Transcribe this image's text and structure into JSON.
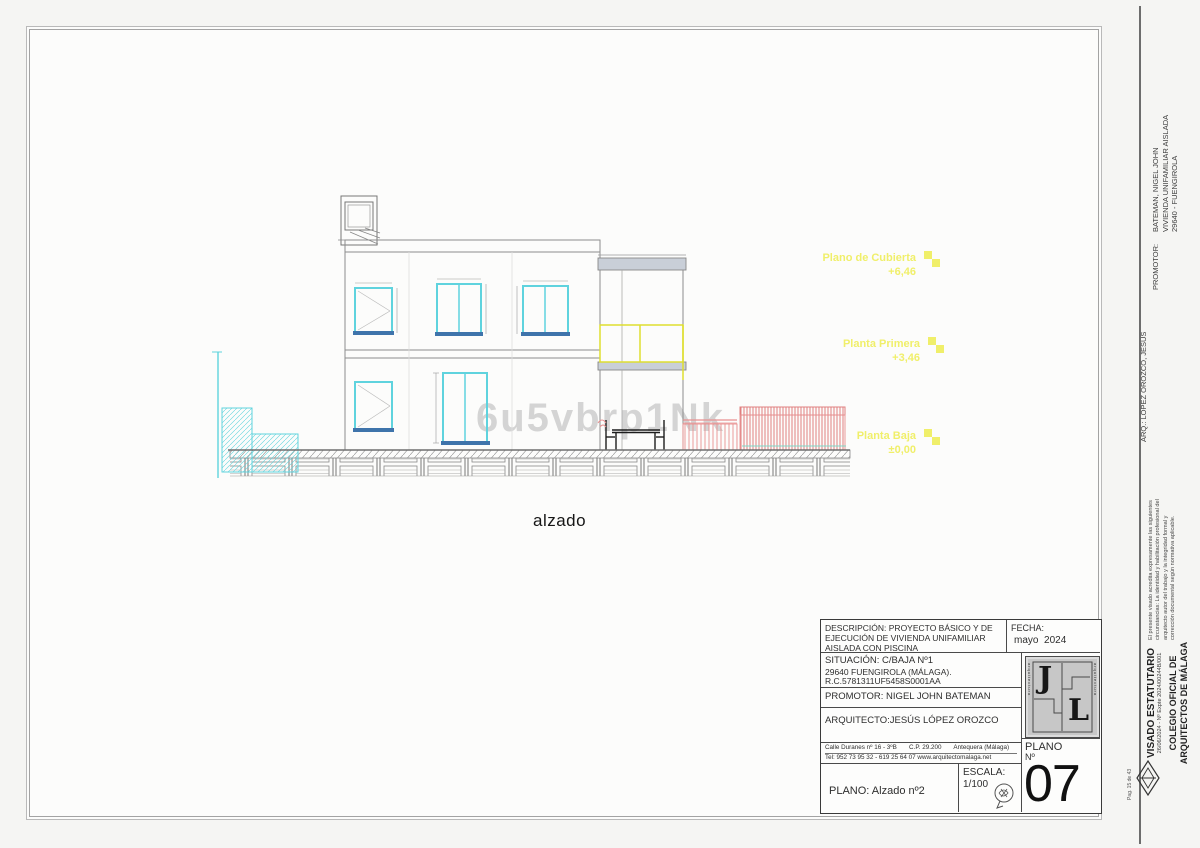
{
  "sheet": {
    "drawing_label": "alzado",
    "watermark": "6u5vbrp1Nk",
    "levels": [
      {
        "label": "Plano de Cubierta",
        "value": "+6,46"
      },
      {
        "label": "Planta Primera",
        "value": "+3,46"
      },
      {
        "label": "Planta Baja",
        "value": "±0,00"
      }
    ]
  },
  "title_block": {
    "descripcion_l1": "DESCRIPCIÓN: PROYECTO BÁSICO Y DE",
    "descripcion_l2": "EJECUCIÓN DE VIVIENDA UNIFAMILIAR",
    "descripcion_l3": "AISLADA CON PISCINA",
    "fecha_label": "FECHA:",
    "fecha_value": "mayo  2024",
    "situacion_l1": "SITUACIÓN:  C/BAJA Nº1",
    "situacion_l2": "29640 FUENGIROLA (MÁLAGA).",
    "situacion_l3": "R.C.5781311UF5458S0001AA",
    "promotor": "PROMOTOR: NIGEL JOHN BATEMAN",
    "arquitecto": "ARQUITECTO:JESÚS LÓPEZ OROZCO",
    "address": "Calle Duranes nº 16 - 3ºB       C.P. 29.200       Antequera (Málaga)",
    "tel": "Tel: 952 73 95 32 - 619 25 64 07 www.arquitectomalaga.net",
    "plano": "PLANO: Alzado nº2",
    "escala_label": "ESCALA:",
    "escala_value": "1/100",
    "plano_num_label": "PLANO",
    "plano_num_no": "Nº",
    "plano_num_value": "07",
    "logo_letter1": "J",
    "logo_letter2": "L",
    "logo_side_text": "arquitectura"
  },
  "right_margin": {
    "promotor_label": "PROMOTOR:",
    "promotor_l1": "BATEMAN, NIGEL JOHN",
    "promotor_l2": "VIVIENDA UNIFAMILIAR AISLADA",
    "promotor_l3": "29640 - FUENGIROLA",
    "arq": "ARQ.: LOPEZ OROZCO, JESUS",
    "note_l1": "El presente visado acredita expresamente las siguientes",
    "note_l2": "circunstancias: La identidad y habilitación profesional del",
    "note_l3": "arquitecto autor del trabajo y la integridad formal y",
    "note_l4": "corrección documental según normativa aplicable.",
    "visado_title": "VISADO ESTATUTARIO",
    "visado_expte": "26/06/2024 - Nº Expte 2024/00244B/001",
    "colegio_l1": "COLEGIO OFICIAL DE",
    "colegio_l2": "ARQUITECTOS DE MÁLAGA",
    "page_note": "Pag. 15 de 43"
  },
  "colors": {
    "cyan": "#5fd3de",
    "yellow": "#dede30",
    "pink": "#e89090",
    "slab_gray": "#c9cfd8",
    "level_yellow": "#f0ef6a"
  }
}
